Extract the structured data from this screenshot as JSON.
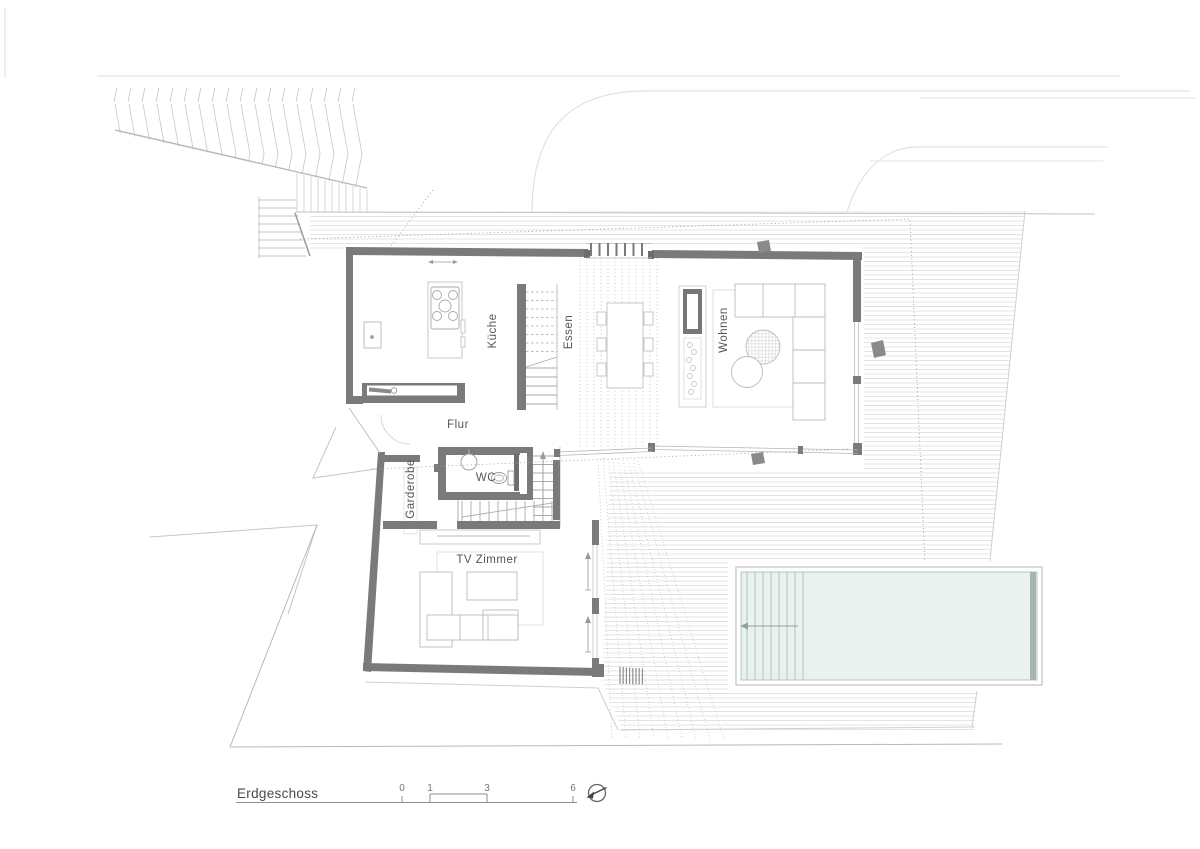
{
  "plan": {
    "title": "Erdgeschoss",
    "room_labels": {
      "kueche": "Küche",
      "essen": "Essen",
      "wohnen": "Wohnen",
      "flur": "Flur",
      "wc": "WC",
      "garderobe": "Garderobe",
      "tv_zimmer": "TV Zimmer"
    },
    "scale_bar": {
      "ticks": [
        "0",
        "1",
        "3",
        "6"
      ]
    },
    "icons": {
      "north_arrow": "compass-needle"
    },
    "colors": {
      "wall": "#7a7a7a",
      "pool_water": "#eaf2ef",
      "deck_hatch": "#e4e4e4",
      "site_line": "#d8d8d8",
      "boundary_line": "#b8b8b8",
      "label_text": "#555555"
    }
  }
}
